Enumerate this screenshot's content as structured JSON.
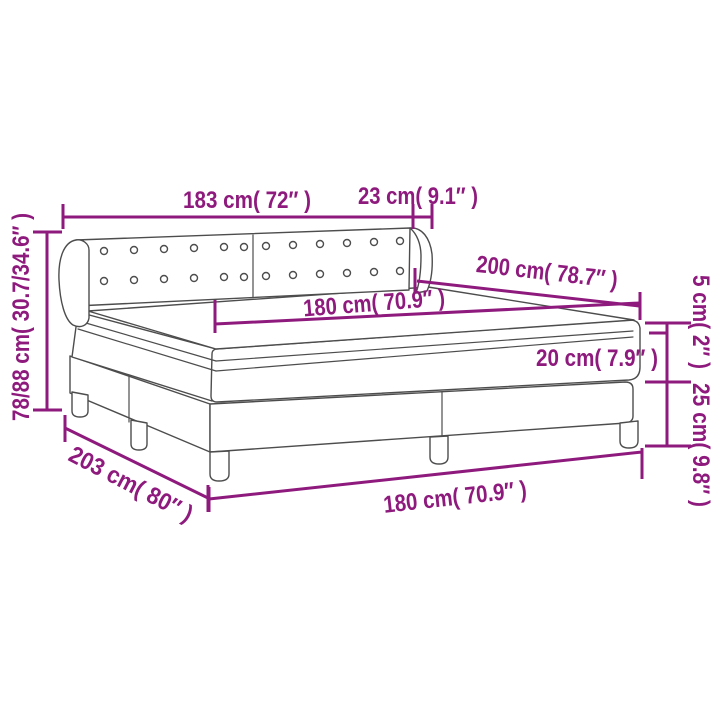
{
  "diagram": {
    "type": "product-dimension-diagram",
    "subject": "box-spring-bed-with-tufted-headboard",
    "accent_color": "#8E1A7D",
    "art_color": "#4d4d4d",
    "labels": {
      "headboard_width": "183 cm( 72″ )",
      "headboard_wing_depth": "23 cm( 9.1″ )",
      "bed_length": "200 cm( 78.7″ )",
      "mattress_width_top": "180 cm( 70.9″ )",
      "mattress_height": "20 cm( 7.9″ )",
      "topper_height": "5 cm( 2″ )",
      "base_height": "25 cm( 9.8″ )",
      "headboard_height": "78/88 cm( 30.7/34.6″ )",
      "base_length": "203 cm( 80″ )",
      "base_width": "180 cm( 70.9″ )"
    }
  }
}
